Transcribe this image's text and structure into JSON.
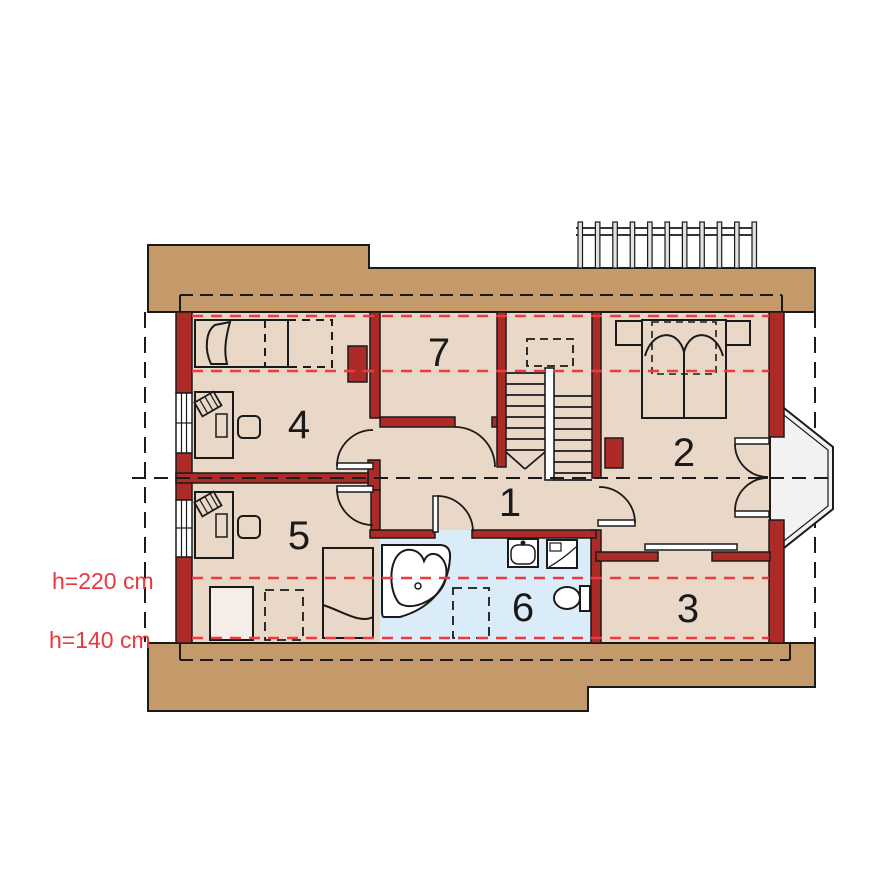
{
  "plan_title": "attic floor plan",
  "rooms": [
    {
      "label": "1"
    },
    {
      "label": "2"
    },
    {
      "label": "3"
    },
    {
      "label": "4"
    },
    {
      "label": "5"
    },
    {
      "label": "6"
    },
    {
      "label": "7"
    }
  ],
  "annotations": {
    "h220": "h=220 cm",
    "h140": "h=140 cm"
  },
  "colors": {
    "wall_red": "#AD2B26",
    "roof_tan": "#C49A6B",
    "floor_beige": "#E9D8C8",
    "bathroom_blue": "#D9ECF8",
    "height_line_red": "#EE3B41",
    "outline_black": "#1A1A1A",
    "bay_fill": "#F2F2F2"
  },
  "furniture_icons": [
    "single-bed-icon",
    "double-bed-icon",
    "nightstand-icon",
    "desk-icon",
    "chair-icon",
    "papers-icon",
    "wardrobe-icon",
    "corner-bathtub-icon",
    "sink-icon",
    "washing-machine-icon",
    "toilet-icon",
    "staircase-icon",
    "balcony-railing-icon",
    "bay-window-icon",
    "chimney-icon",
    "roof-window-icon",
    "window-icon",
    "door-swing-icon",
    "sliding-door-icon"
  ]
}
